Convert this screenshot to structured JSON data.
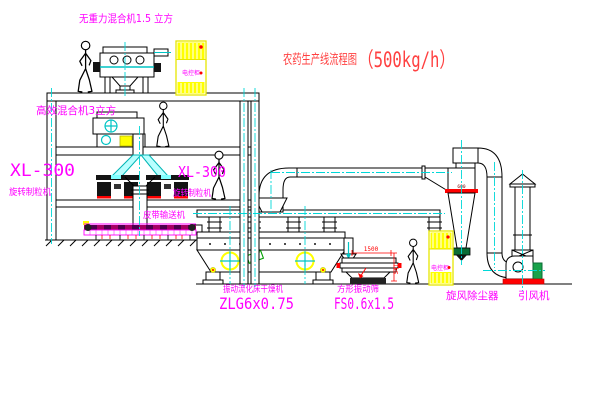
{
  "title": {
    "name": "农药生产线流程图",
    "capacity": "（500kg/h）"
  },
  "labels": {
    "top_mixer": "无重力混合机1.5 立方",
    "second_mixer": "高效混合机3立方",
    "granulator_left_model": "XL-300",
    "granulator_left_name": "旋转制粒机",
    "granulator_middle_model": "XL-300",
    "granulator_middle_name": "旋转制粒机",
    "belt_conveyor": "皮带输送机",
    "dryer_name": "振动流化床干燥机",
    "dryer_model": "ZLG6x0.75",
    "sieve_name": "方形振动筛",
    "sieve_model": "FS0.6x1.5",
    "cyclone": "旋风除尘器",
    "fan": "引风机",
    "control_cabinet": "电控柜"
  },
  "dimensions": {
    "sieve_length": "1500",
    "sieve_height": "541",
    "cyclone_note": "600"
  },
  "colors": {
    "label_magenta": "#ff00ff",
    "title_red": "#ff4040",
    "centerline_cyan": "#00d8d8",
    "cabinet_yellow": "#ffff00",
    "dim_red": "#ff0000",
    "motor_green": "#19a24a"
  }
}
